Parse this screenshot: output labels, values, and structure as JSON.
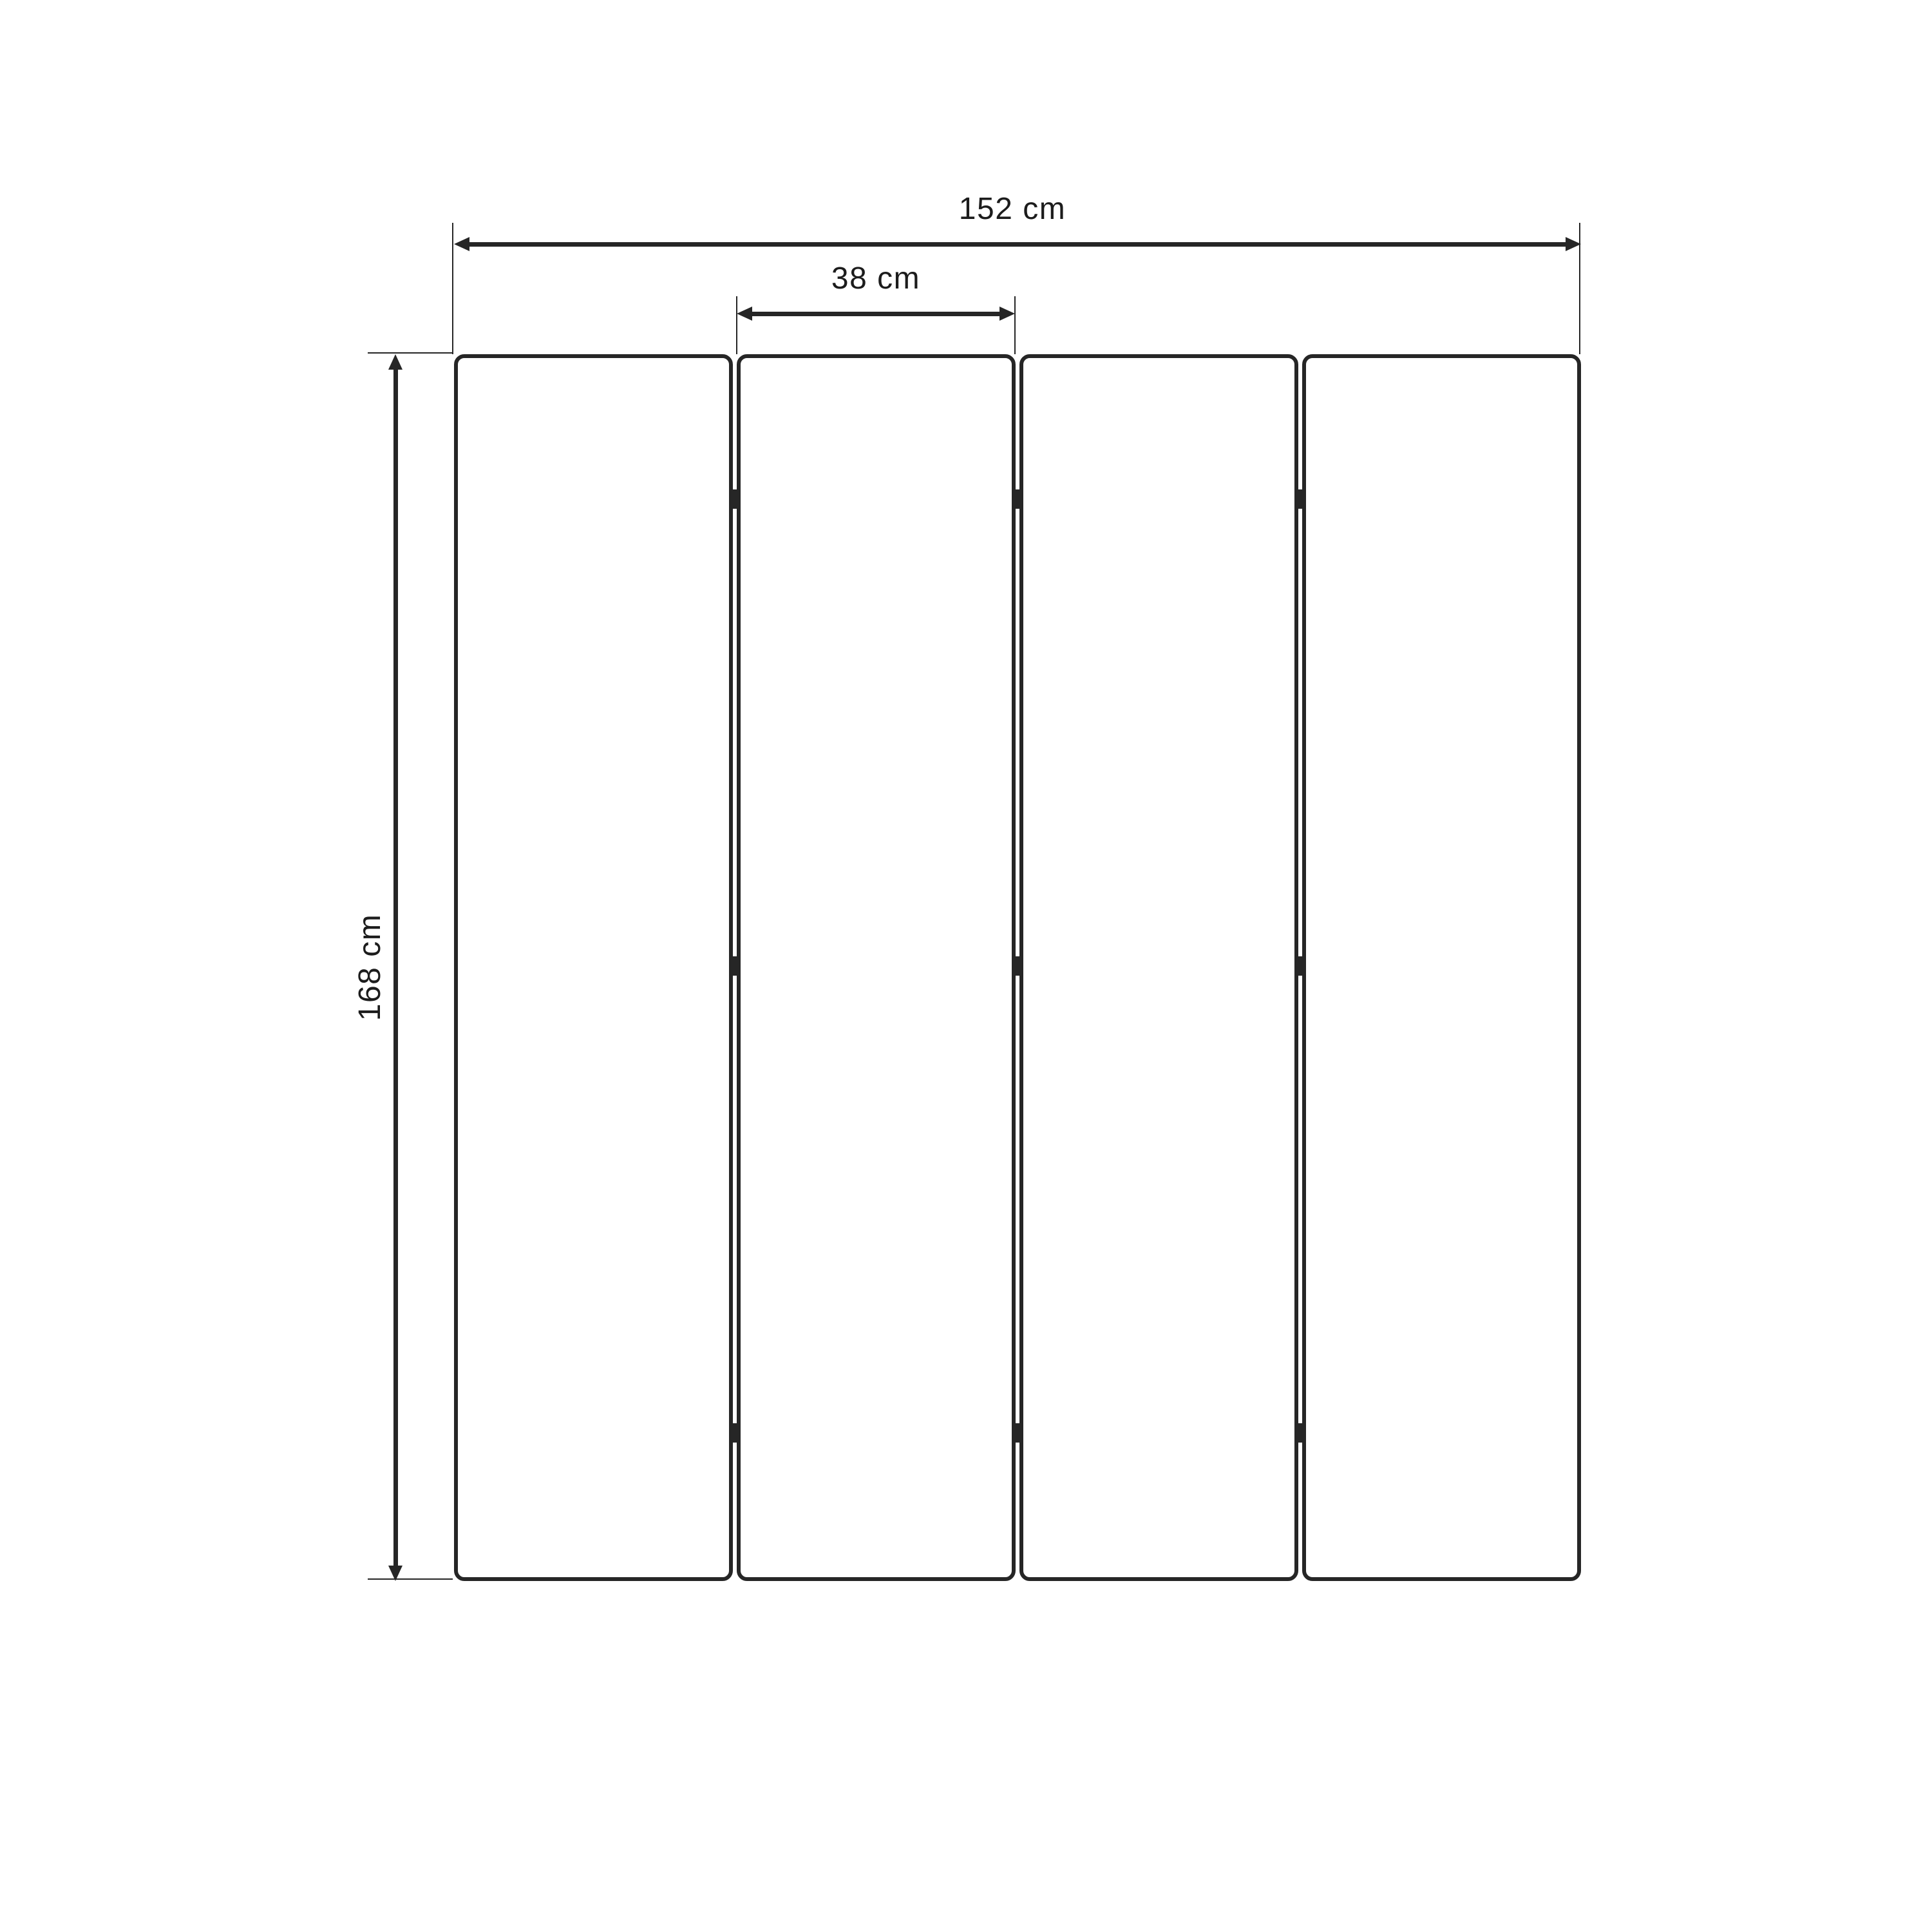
{
  "diagram": {
    "panel_count": 4,
    "gap_count": 3,
    "hinge_marks_per_gap": 3,
    "labels": {
      "total_width": "152 cm",
      "single_panel_width": "38 cm",
      "panel_height": "168 cm"
    },
    "colors": {
      "line": "#262626",
      "text": "#1c1c1c",
      "panel_fill": "#ffffff",
      "background": "#ffffff"
    }
  }
}
